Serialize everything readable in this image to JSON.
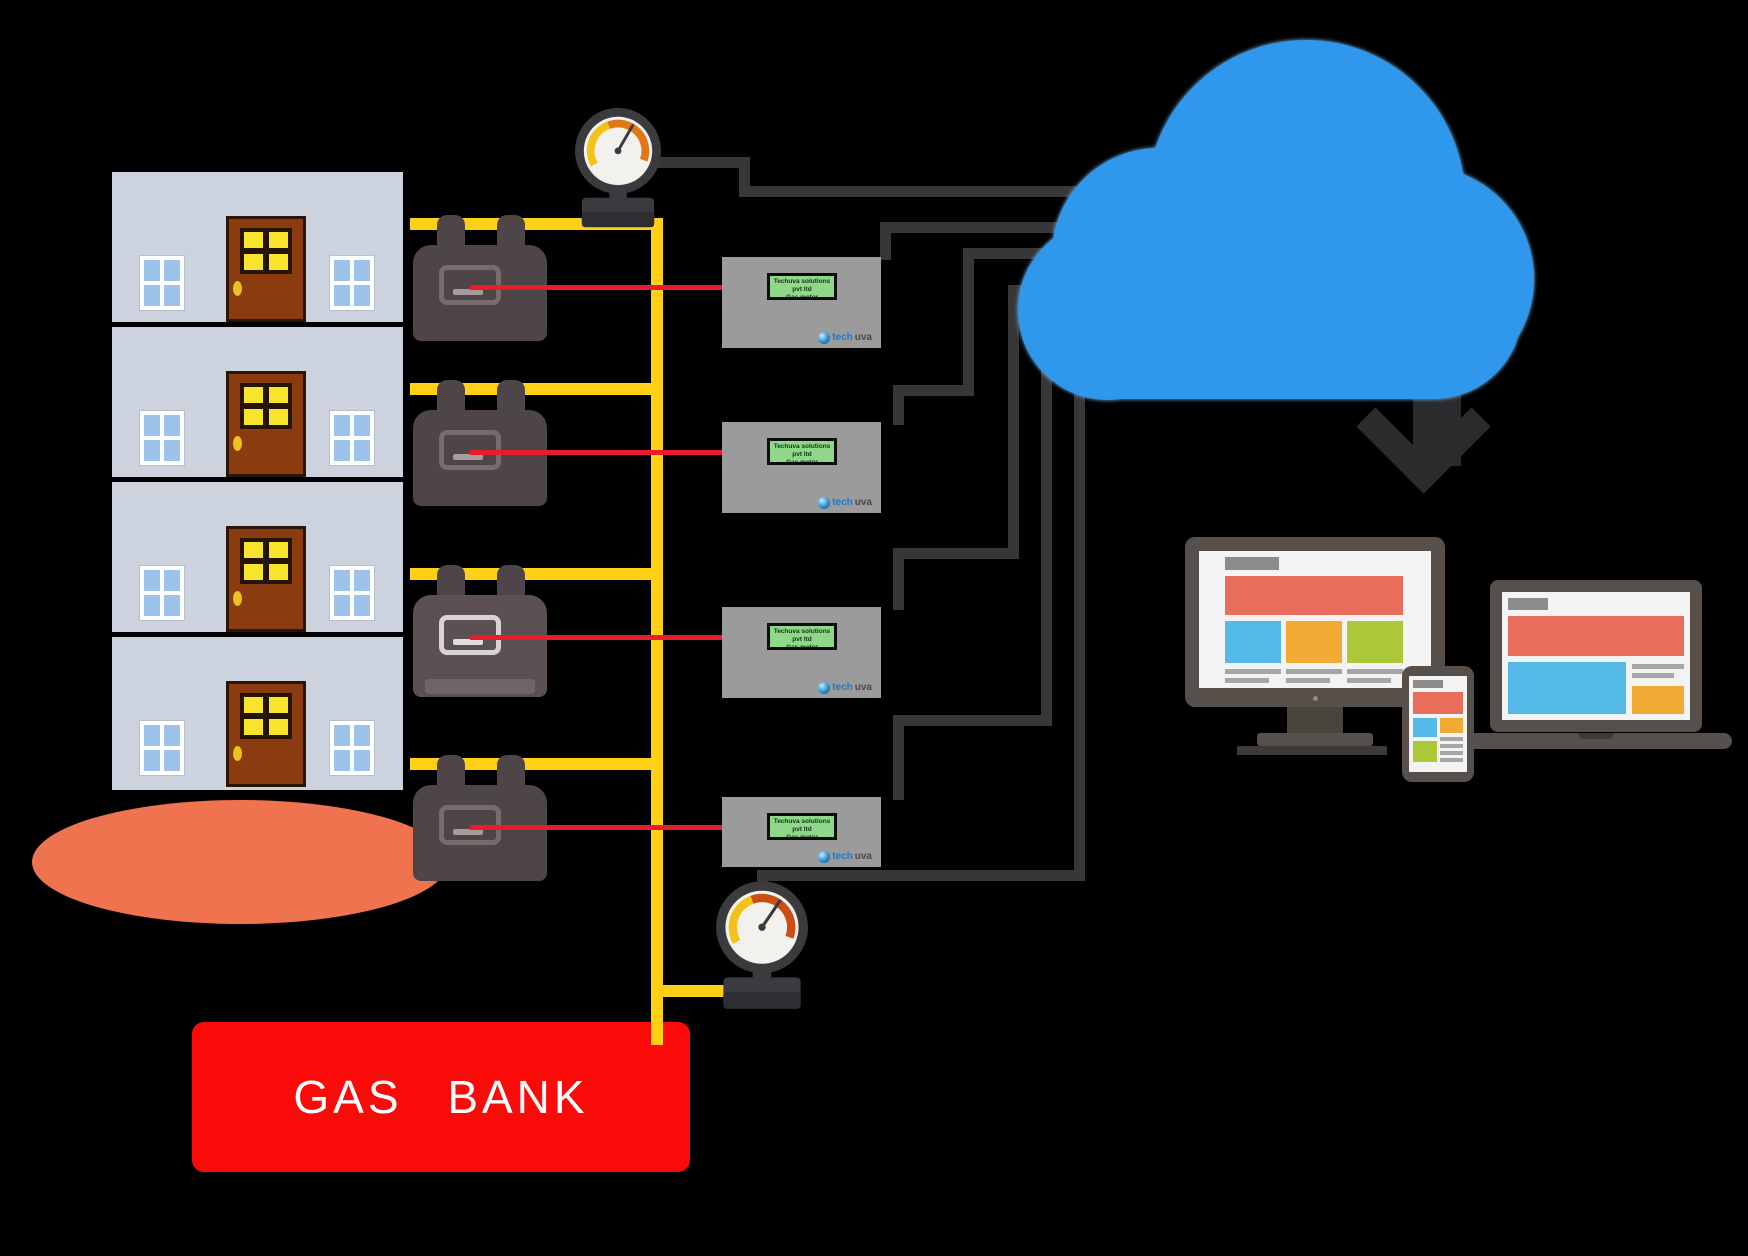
{
  "diagram": {
    "description": "Smart prepaid gas metering system: building floors with gas meters piped to a gas bank, transmitters sending data to the cloud and on to user devices"
  },
  "gas_bank": {
    "label": "GAS BANK"
  },
  "transmitter": {
    "display_line1": "Techuva solutions pvt ltd",
    "display_line2": "Gas meter",
    "brand_prefix": "tech",
    "brand_suffix": "uva",
    "count": 4
  },
  "building": {
    "floor_count": 4,
    "meters_count": 4
  },
  "gauges": {
    "count": 2
  },
  "colors": {
    "background": "#000000",
    "wall": "#ccd3de",
    "door_brown": "#8a3c10",
    "glass_yellow": "#f8e42c",
    "window_blue": "#9dc3ea",
    "pipe_yellow": "#ffd013",
    "meter_dark": "#4d4547",
    "signal_red": "#e81c2c",
    "link_dark": "#37373a",
    "box_gray": "#9b9b9b",
    "display_green": "#8fd88a",
    "cloud_blue": "#2f97ec",
    "arrow_dark": "#2b2b2e",
    "gasbank_red": "#fb0a0a",
    "ground_salmon": "#f0734f",
    "device_frame": "#57504a",
    "screen_red": "#e96d5c",
    "screen_blue": "#55b9e7",
    "screen_orange": "#f2aa37",
    "screen_green": "#aac838"
  }
}
